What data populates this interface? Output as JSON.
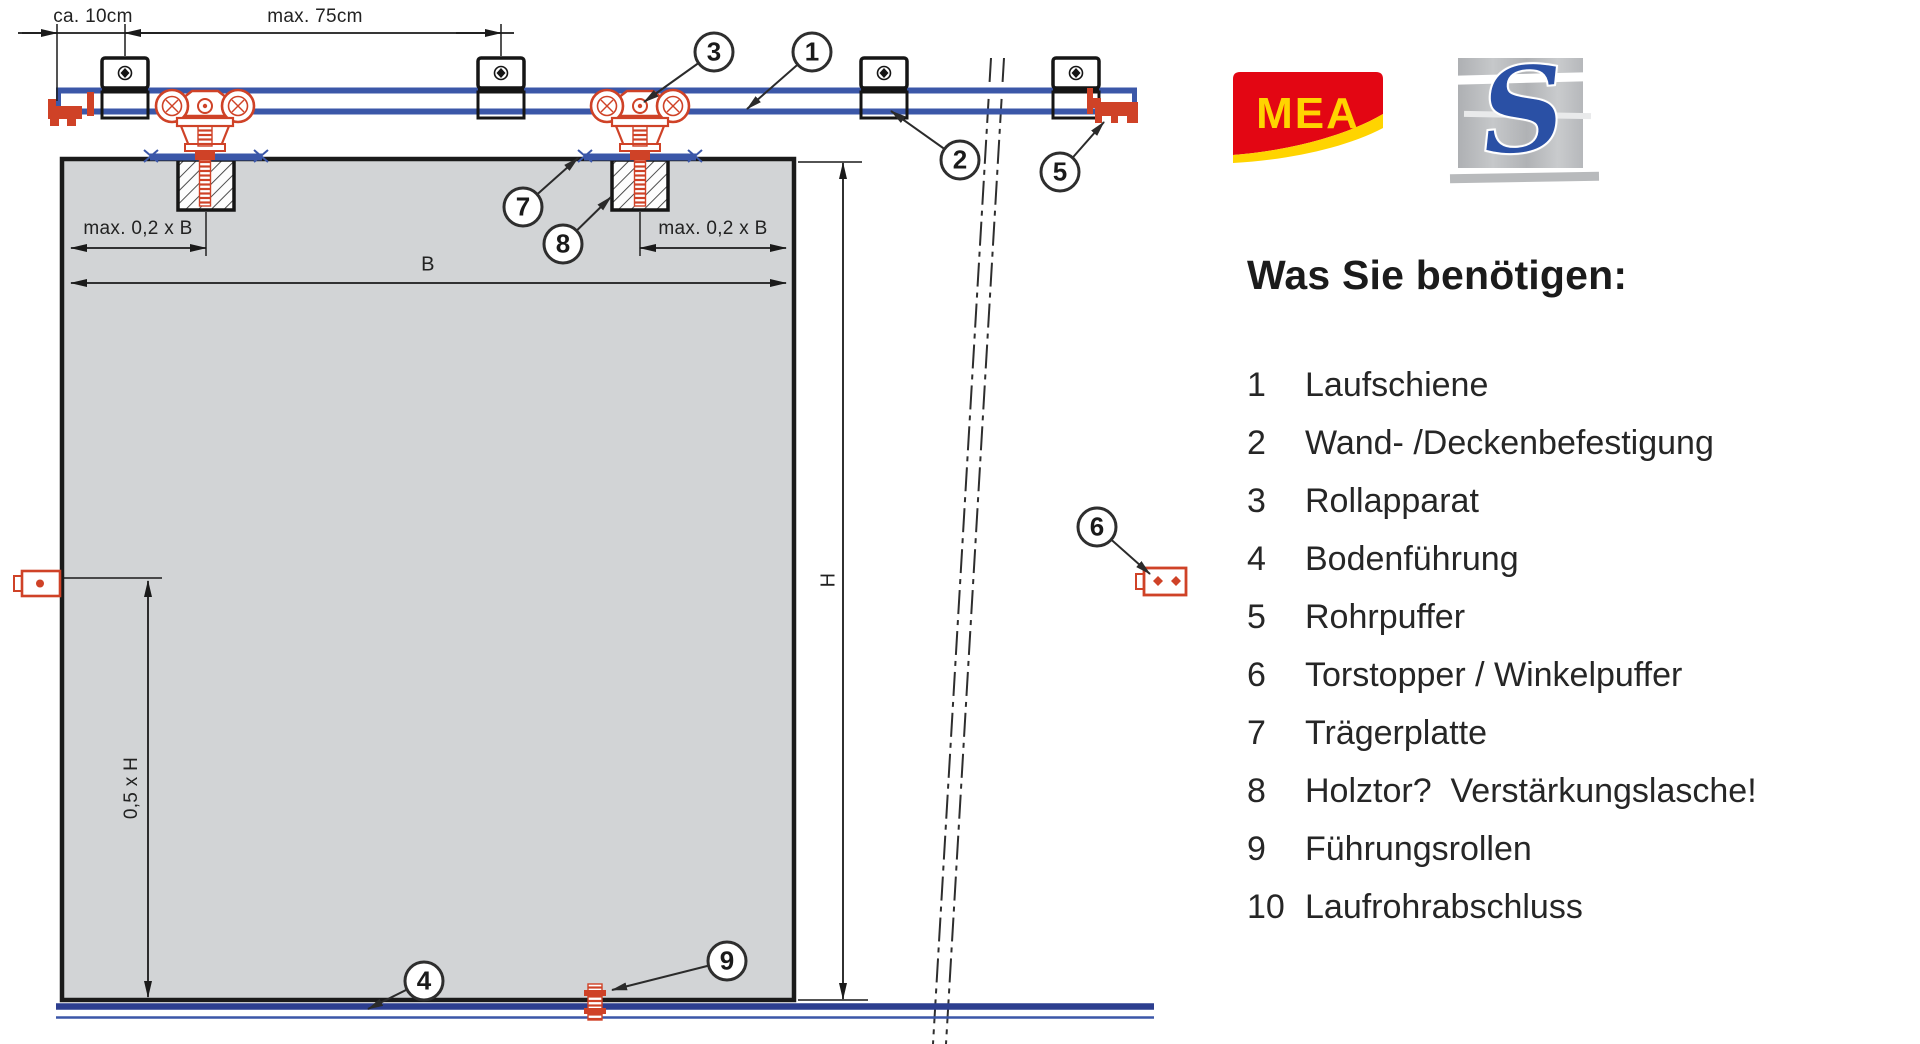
{
  "diagram": {
    "dims": {
      "ca10": "ca. 10cm",
      "max75": "max. 75cm",
      "b02_left": "max. 0,2 x B",
      "b02_right": "max. 0,2 x B",
      "b": "B",
      "h": "H",
      "h05": "0,5 x H"
    },
    "callouts": [
      {
        "n": "1"
      },
      {
        "n": "2"
      },
      {
        "n": "3"
      },
      {
        "n": "4"
      },
      {
        "n": "5"
      },
      {
        "n": "6"
      },
      {
        "n": "7"
      },
      {
        "n": "8"
      },
      {
        "n": "9"
      }
    ]
  },
  "logos": {
    "mea": "MEA",
    "s": "S"
  },
  "panel": {
    "heading": "Was Sie benötigen:",
    "items": [
      {
        "num": "1",
        "label": "Laufschiene"
      },
      {
        "num": "2",
        "label": "Wand- /Deckenbefestigung"
      },
      {
        "num": "3",
        "label": "Rollapparat"
      },
      {
        "num": "4",
        "label": "Bodenführung"
      },
      {
        "num": "5",
        "label": "Rohrpuffer"
      },
      {
        "num": "6",
        "label": "Torstopper / Winkelpuffer"
      },
      {
        "num": "7",
        "label": "Trägerplatte"
      },
      {
        "num": "8",
        "label": "Holztor?  Verstärkungslasche!"
      },
      {
        "num": "9",
        "label": "Führungsrollen"
      },
      {
        "num": "10",
        "label": "Laufrohrabschluss"
      }
    ]
  },
  "colors": {
    "track_blue": "#3b57a8",
    "rail_navy": "#2c3e8f",
    "part_red": "#cf4227",
    "door_gray": "#d2d4d6",
    "mea_red": "#e30613",
    "mea_yellow": "#ffd400",
    "s_blue": "#2a50a5",
    "logo_gray": "#b3b5b8"
  }
}
